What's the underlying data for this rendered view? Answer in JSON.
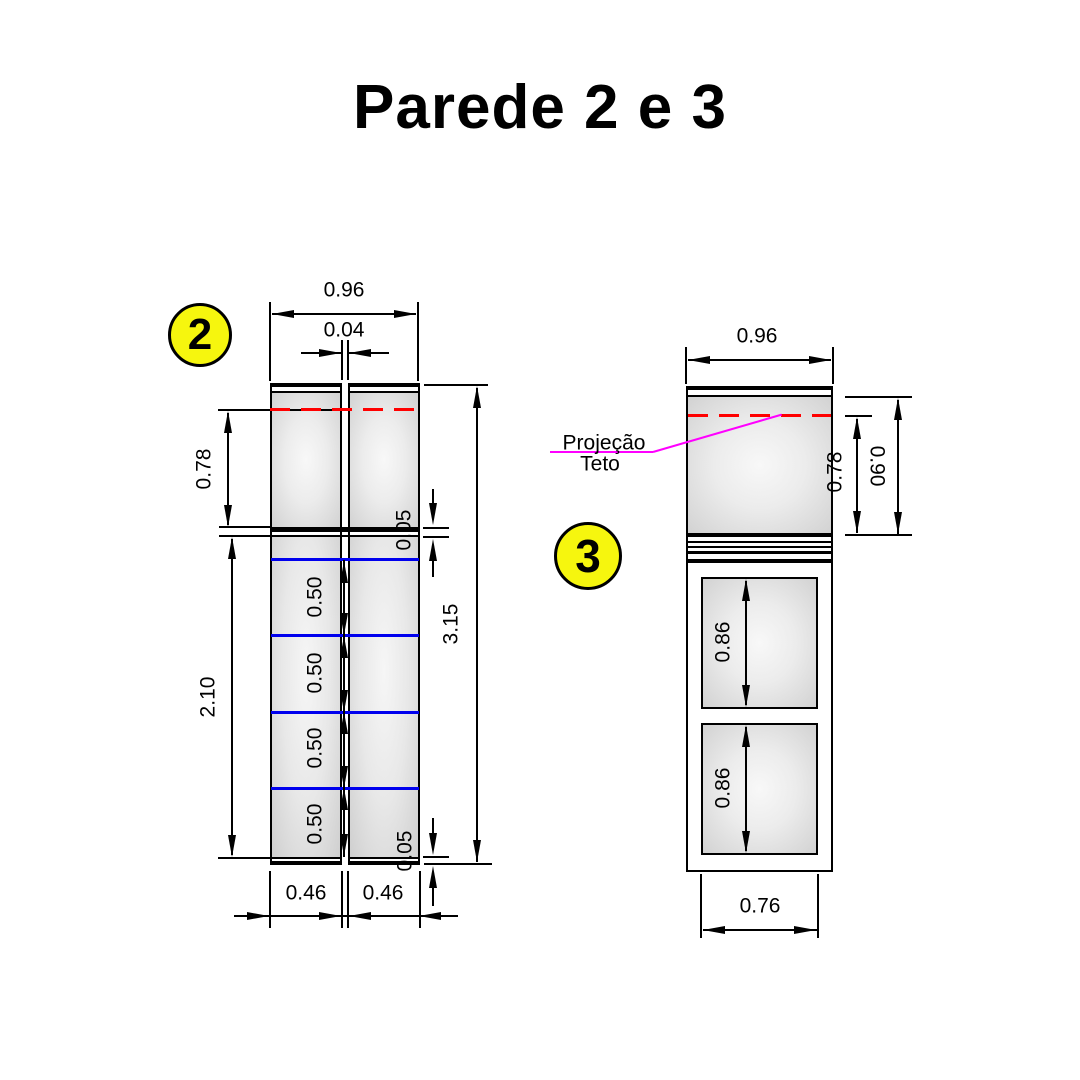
{
  "title": "Parede 2 e 3",
  "balloons": {
    "left": "2",
    "right": "3"
  },
  "projection_label": {
    "line1": "Projeção",
    "line2": "Teto"
  },
  "dims": {
    "left_overall_width": "0.96",
    "left_gap": "0.04",
    "left_upper_height": "0.78",
    "left_top_band": "0.05",
    "left_segment_1": "0.50",
    "left_segment_2": "0.50",
    "left_segment_3": "0.50",
    "left_segment_4": "0.50",
    "left_lower_height": "2.10",
    "left_total_height": "3.15",
    "left_panel_width_1": "0.46",
    "left_panel_width_2": "0.46",
    "left_bottom_band": "0.05",
    "right_overall_width": "0.96",
    "right_ceiling_offset": "0.78",
    "right_panel_height": "0.90",
    "right_opening_1": "0.86",
    "right_opening_2": "0.86",
    "right_inner_width": "0.76"
  },
  "colors": {
    "balloon_yellow": "#f6f60e",
    "grid_blue": "#0000ee",
    "ceiling_red": "#ff0000",
    "leader_magenta": "#ff00ff",
    "line_black": "#000000"
  }
}
